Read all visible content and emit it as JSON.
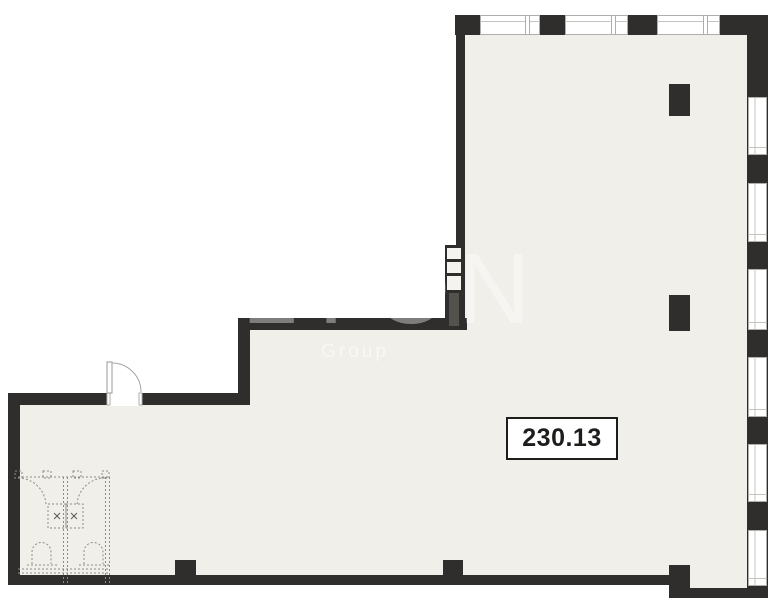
{
  "floor_plan": {
    "area_label": "230.13",
    "watermark_title": "LYON",
    "watermark_subtitle": "Group"
  },
  "colors": {
    "floor": "#f0efe9",
    "walls": "#2f2e2c",
    "exterior": "#ffffff",
    "window_frame": "#b0aeaa",
    "window_glass_line": "#c6c4c0",
    "shaft_fill": "#54524c",
    "fixture_dashed_lines": "#8e8c86",
    "door_swing_line": "#a8a6a2",
    "area_label_border": "#1d1d1b",
    "area_label_text": "#1d1d1b"
  }
}
